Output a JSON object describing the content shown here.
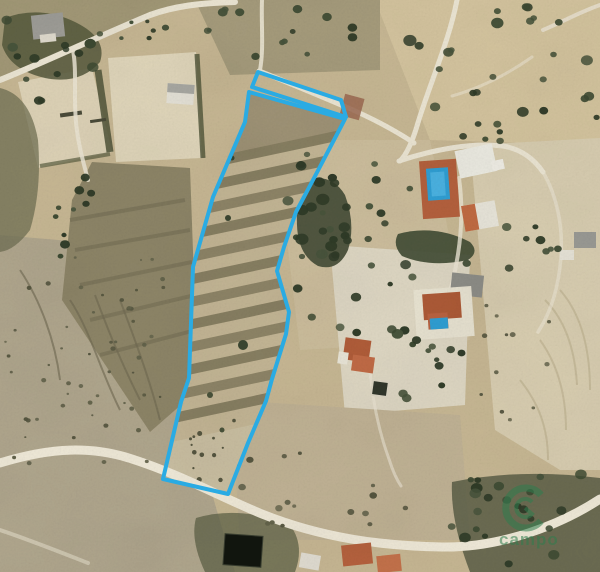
{
  "watermark": {
    "text": "campo",
    "icon": "g-ring-logo",
    "color": "#2f7d4e"
  },
  "overlay": {
    "parcel_boundary": {
      "color": "#2aabe3",
      "stroke_width": 4,
      "strip_points": "258,72 341,100 346,117 252,87",
      "body_points": "249,92 345,119 313,180 296,212 284,247 277,271 289,312 286,334 272,379 266,401 248,443 228,494 163,479 181,402 189,378 193,267 213,197 245,122"
    }
  }
}
